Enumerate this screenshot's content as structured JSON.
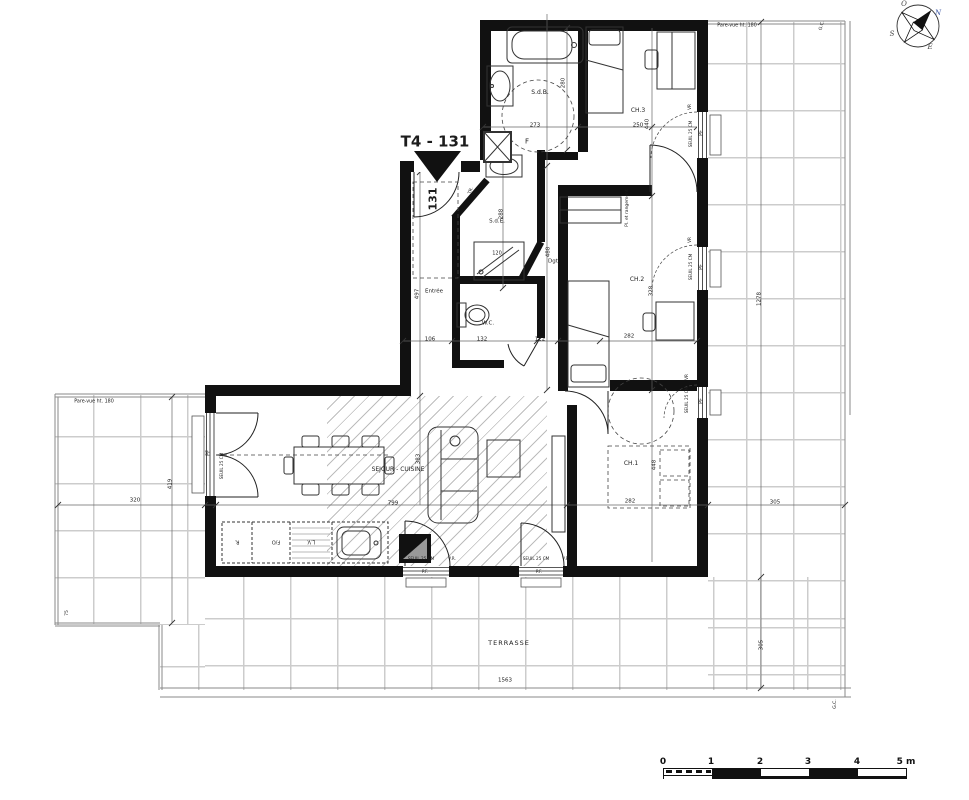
{
  "plan": {
    "type": "apartment floor plan",
    "title": "T4 - 131",
    "door_number": "131"
  },
  "labels": {
    "rooms": [
      {
        "id": "room-label-sdb",
        "t": "S.d.B.",
        "x": 540,
        "y": 93,
        "r": 0,
        "s": 6
      },
      {
        "id": "room-label-ch3",
        "t": "CH.3",
        "x": 638,
        "y": 111,
        "r": 0,
        "s": 6
      },
      {
        "id": "room-label-sde",
        "t": "S.d.E.",
        "x": 497,
        "y": 222,
        "r": 0,
        "s": 5.5
      },
      {
        "id": "room-label-entree",
        "t": "Entrée",
        "x": 434,
        "y": 292,
        "r": 0,
        "s": 5.5
      },
      {
        "id": "room-label-wc",
        "t": "W.C.",
        "x": 488,
        "y": 324,
        "r": 0,
        "s": 5.5
      },
      {
        "id": "room-label-dgt",
        "t": "Dgt",
        "x": 553,
        "y": 262,
        "r": 0,
        "s": 5.5
      },
      {
        "id": "room-label-ch2",
        "t": "CH.2",
        "x": 637,
        "y": 280,
        "r": 0,
        "s": 6
      },
      {
        "id": "room-label-ch1",
        "t": "CH.1",
        "x": 631,
        "y": 464,
        "r": 0,
        "s": 6
      },
      {
        "id": "room-label-sejour-cuisine",
        "t": "SEJOUR - CUISINE",
        "x": 398,
        "y": 470,
        "r": 0,
        "s": 6
      },
      {
        "id": "room-label-terrasse",
        "t": "TERRASSE",
        "x": 509,
        "y": 643,
        "r": 0,
        "s": 6.5,
        "ls": 1
      },
      {
        "id": "room-label-rangement",
        "t": "Pl. et rangement",
        "x": 628,
        "y": 208,
        "r": -90,
        "s": 4.5
      }
    ],
    "dimensions": [
      {
        "id": "dim-280",
        "t": "280",
        "x": 564,
        "y": 83,
        "r": -90,
        "s": 5.5
      },
      {
        "id": "dim-273",
        "t": "273",
        "x": 535,
        "y": 126,
        "r": 0,
        "s": 5.5
      },
      {
        "id": "dim-250",
        "t": "250",
        "x": 638,
        "y": 126,
        "r": 0,
        "s": 5.5
      },
      {
        "id": "dim-440",
        "t": "440",
        "x": 648,
        "y": 124,
        "r": -90,
        "s": 5.5
      },
      {
        "id": "dim-288",
        "t": "288",
        "x": 502,
        "y": 214,
        "r": -90,
        "s": 5.5
      },
      {
        "id": "dim-497",
        "t": "497",
        "x": 418,
        "y": 294,
        "r": -90,
        "s": 5.5
      },
      {
        "id": "dim-106",
        "t": "106",
        "x": 430,
        "y": 340,
        "r": 0,
        "s": 5.5
      },
      {
        "id": "dim-132",
        "t": "132",
        "x": 482,
        "y": 340,
        "r": 0,
        "s": 5.5
      },
      {
        "id": "dim-122",
        "t": "122",
        "x": 540,
        "y": 340,
        "r": 0,
        "s": 5.5
      },
      {
        "id": "dim-488",
        "t": "488",
        "x": 549,
        "y": 252,
        "r": -90,
        "s": 5.5
      },
      {
        "id": "dim-328",
        "t": "328",
        "x": 652,
        "y": 291,
        "r": -90,
        "s": 5.5
      },
      {
        "id": "dim-282-ch2",
        "t": "282",
        "x": 629,
        "y": 337,
        "r": 0,
        "s": 5.5
      },
      {
        "id": "dim-448",
        "t": "448",
        "x": 655,
        "y": 465,
        "r": -90,
        "s": 5.5
      },
      {
        "id": "dim-282-ch1",
        "t": "282",
        "x": 630,
        "y": 502,
        "r": 0,
        "s": 5.5
      },
      {
        "id": "dim-383",
        "t": "383",
        "x": 419,
        "y": 459,
        "r": -90,
        "s": 5.5
      },
      {
        "id": "dim-799",
        "t": "799",
        "x": 393,
        "y": 504,
        "r": 0,
        "s": 5.5
      },
      {
        "id": "dim-320",
        "t": "320",
        "x": 135,
        "y": 501,
        "r": 0,
        "s": 5.5
      },
      {
        "id": "dim-419",
        "t": "419",
        "x": 171,
        "y": 484,
        "r": -90,
        "s": 5.5
      },
      {
        "id": "dim-75",
        "t": "75",
        "x": 68,
        "y": 613,
        "r": -90,
        "s": 4.5
      },
      {
        "id": "dim-1563",
        "t": "1563",
        "x": 505,
        "y": 681,
        "r": 0,
        "s": 5.5
      },
      {
        "id": "dim-1278",
        "t": "1278",
        "x": 760,
        "y": 299,
        "r": -90,
        "s": 5.5
      },
      {
        "id": "dim-305-right",
        "t": "305",
        "x": 775,
        "y": 503,
        "r": 0,
        "s": 5.5
      },
      {
        "id": "dim-305-bottom",
        "t": "305",
        "x": 762,
        "y": 645,
        "r": -90,
        "s": 5.5
      },
      {
        "id": "dim-120-shower",
        "t": "120",
        "x": 497,
        "y": 254,
        "r": 0,
        "s": 5
      }
    ],
    "annotations": [
      {
        "id": "plan-title",
        "t": "T4 - 131",
        "x": 435,
        "y": 142,
        "r": 0,
        "s": 15,
        "b": 1
      },
      {
        "id": "door-number",
        "t": "131",
        "x": 433,
        "y": 199,
        "r": -90,
        "s": 11,
        "b": 1
      },
      {
        "id": "pare-vue-left",
        "t": "Pare-vue ht. 180",
        "x": 94,
        "y": 403,
        "r": 0,
        "s": 4.8
      },
      {
        "id": "pare-vue-right",
        "t": "Pare-vue ht. 180",
        "x": 737,
        "y": 27,
        "r": 0,
        "s": 4.8
      },
      {
        "id": "gc-top",
        "t": "G.C.",
        "x": 823,
        "y": 26,
        "r": -75,
        "s": 4.5
      },
      {
        "id": "gc-bottom",
        "t": "G.C.",
        "x": 836,
        "y": 704,
        "r": -90,
        "s": 4.5
      },
      {
        "id": "duct-f",
        "t": "F",
        "x": 527,
        "y": 142,
        "r": 0,
        "s": 7
      },
      {
        "id": "closet-tr",
        "t": "TR.",
        "x": 472,
        "y": 191,
        "r": -70,
        "s": 4.5
      },
      {
        "id": "kitchen-fridge",
        "t": "R.",
        "x": 237,
        "y": 541,
        "r": 180,
        "s": 5
      },
      {
        "id": "kitchen-oven",
        "t": "F/O",
        "x": 276,
        "y": 541,
        "r": 180,
        "s": 5
      },
      {
        "id": "kitchen-dishwasher",
        "t": "L.V.",
        "x": 311,
        "y": 541,
        "r": 180,
        "s": 5
      }
    ],
    "window_marks": [
      {
        "id": "win-ch3-vr",
        "t": "VR",
        "x": 690,
        "y": 107,
        "r": -90,
        "s": 4.2
      },
      {
        "id": "win-ch3-seuil",
        "t": "SEUIL 25 CM",
        "x": 691,
        "y": 134,
        "r": -90,
        "s": 4.2
      },
      {
        "id": "win-ch3-pf",
        "t": "PF",
        "x": 703,
        "y": 133,
        "r": -90,
        "s": 4.8
      },
      {
        "id": "win-ch2-vr",
        "t": "VR",
        "x": 690,
        "y": 240,
        "r": -90,
        "s": 4.2
      },
      {
        "id": "win-ch2-seuil",
        "t": "SEUIL 25 CM",
        "x": 691,
        "y": 267,
        "r": -90,
        "s": 4.2
      },
      {
        "id": "win-ch2-pf",
        "t": "PF",
        "x": 703,
        "y": 267,
        "r": -90,
        "s": 4.8
      },
      {
        "id": "win-ch1-vr",
        "t": "VR",
        "x": 687,
        "y": 377,
        "r": -90,
        "s": 4.2
      },
      {
        "id": "win-ch1-seuil",
        "t": "SEUIL 25 CM",
        "x": 687,
        "y": 400,
        "r": -90,
        "s": 4.2
      },
      {
        "id": "win-ch1-pf",
        "t": "PF",
        "x": 703,
        "y": 401,
        "r": -90,
        "s": 4.8
      },
      {
        "id": "door-b1-seuil",
        "t": "SEUIL 25 CM",
        "x": 421,
        "y": 559,
        "r": 0,
        "s": 4.2
      },
      {
        "id": "door-b1-vr",
        "t": "V.R.",
        "x": 452,
        "y": 559,
        "r": 0,
        "s": 4.2
      },
      {
        "id": "door-b1-pf",
        "t": "P.F.",
        "x": 425,
        "y": 572,
        "r": 0,
        "s": 4.2
      },
      {
        "id": "door-b2-seuil",
        "t": "SEUIL 25 CM",
        "x": 536,
        "y": 559,
        "r": 0,
        "s": 4.2
      },
      {
        "id": "door-b2-vr",
        "t": "V.R.",
        "x": 566,
        "y": 559,
        "r": 0,
        "s": 4.2
      },
      {
        "id": "door-b2-pf",
        "t": "P.F.",
        "x": 539,
        "y": 572,
        "r": 0,
        "s": 4.2
      },
      {
        "id": "door-left-pf",
        "t": "PF",
        "x": 210,
        "y": 453,
        "r": -90,
        "s": 4.8
      },
      {
        "id": "door-left-seuil",
        "t": "SEUIL 25 CM",
        "x": 222,
        "y": 466,
        "r": -90,
        "s": 4.2
      }
    ]
  },
  "scale_bar": {
    "unit_labels": [
      "0",
      "1",
      "2",
      "3",
      "4",
      "5 m"
    ]
  },
  "compass": {
    "letters": [
      {
        "t": "N",
        "x": 938,
        "y": 13,
        "c": "#3a55a4"
      },
      {
        "t": "E",
        "x": 930,
        "y": 47,
        "c": "#444444"
      },
      {
        "t": "S",
        "x": 892,
        "y": 34,
        "c": "#444444"
      },
      {
        "t": "O",
        "x": 904,
        "y": 4,
        "c": "#444444"
      }
    ]
  }
}
